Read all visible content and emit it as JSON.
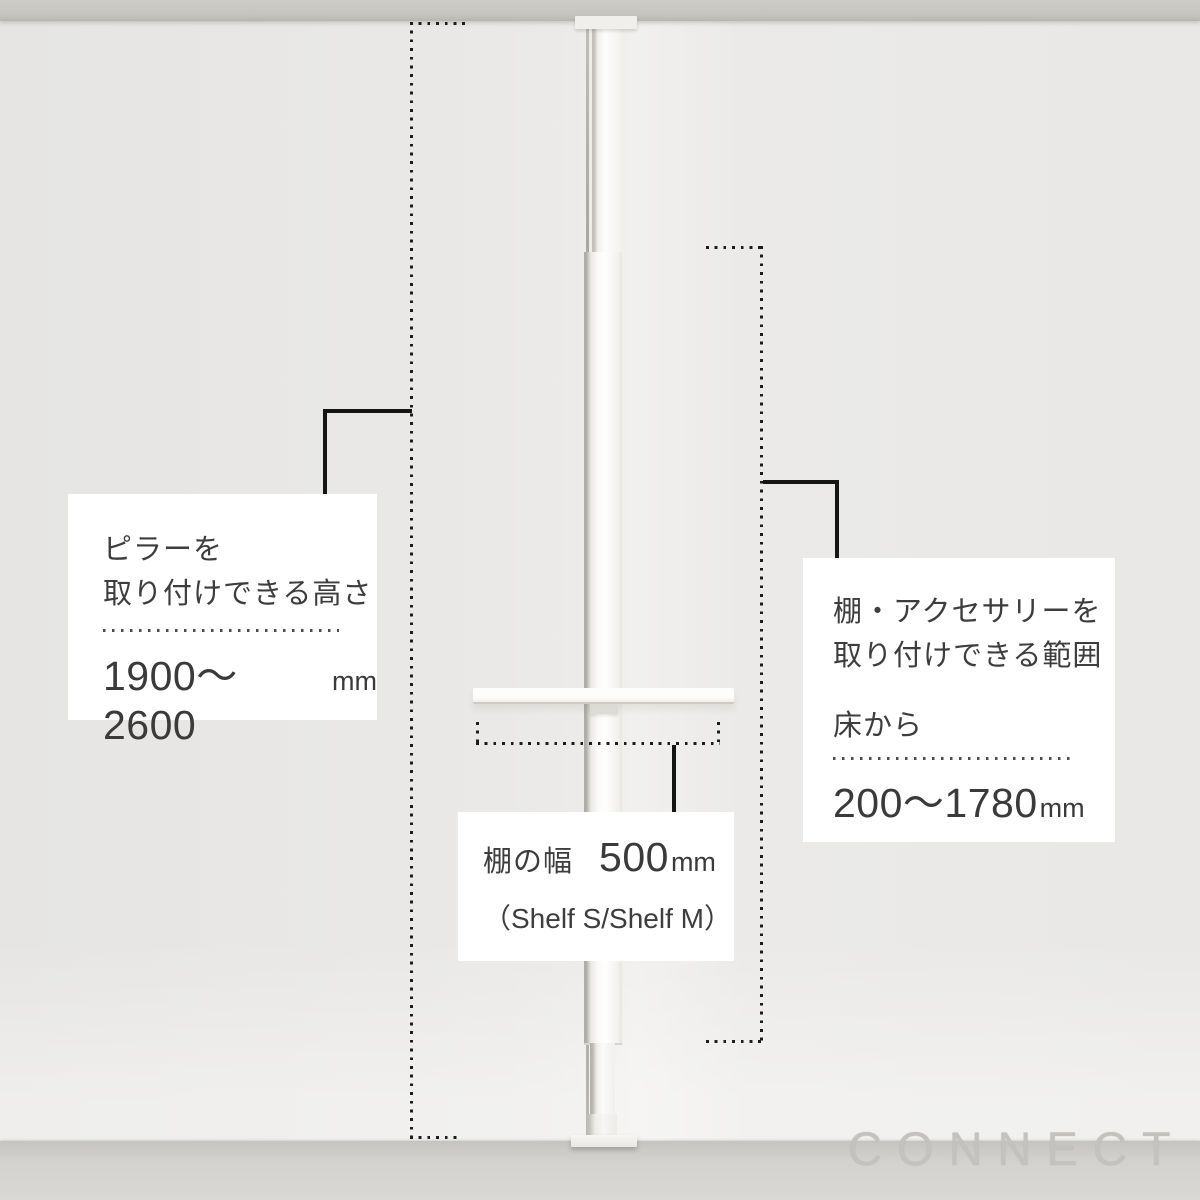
{
  "watermark": "CONNECT",
  "callouts": {
    "pillar_height": {
      "line1": "ピラーを",
      "line2": "取り付けできる高さ",
      "value": "1900〜2600",
      "unit": "mm"
    },
    "mount_range": {
      "line1": "棚・アクセサリーを",
      "line2": "取り付けできる範囲",
      "prefix": "床から",
      "value": "200〜1780",
      "unit": "mm"
    },
    "shelf_width": {
      "label": "棚の幅",
      "value": "500",
      "unit": "mm",
      "note": "（Shelf S/Shelf M）"
    }
  },
  "colors": {
    "annotation_line": "#1a1a1a",
    "callout_text": "#3d3d3d",
    "callout_bg": "#ffffff",
    "wall": "#eae9e7",
    "floor": "#d3d2cf",
    "ceiling": "#c6c4be",
    "pole": "#fbfbfa"
  }
}
